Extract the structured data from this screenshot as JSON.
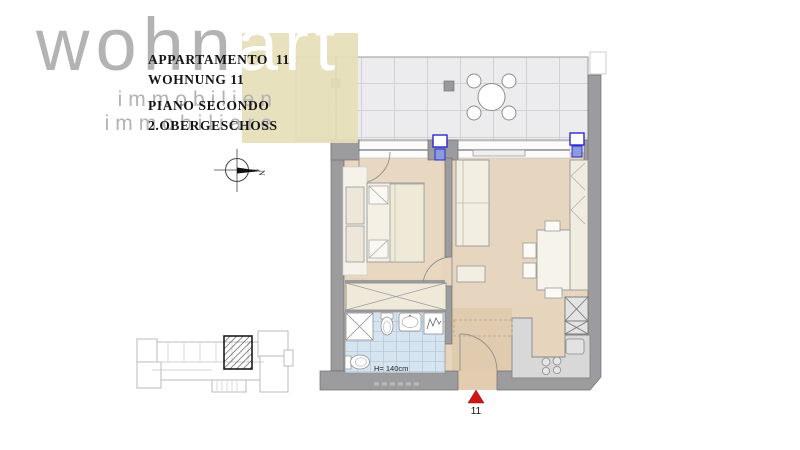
{
  "brand": {
    "name_gray": "wohn",
    "name_accent": "art",
    "subtitle_de": "immobilien",
    "subtitle_it": "immobiliare",
    "accent_block_color": "#e5dfb8",
    "letter_color": "#b3b3b3"
  },
  "unit_info": {
    "title_it": "APPARTAMENTO  11",
    "title_de": "WOHNUNG 11",
    "floor_it": "PIANO SECONDO",
    "floor_de": "2.OBERGESCHOSS"
  },
  "floor_plan": {
    "bathroom_height_label": "H= 140cm",
    "unit_marker": "11",
    "north_label": "N",
    "colors": {
      "wall": "#9c9c9e",
      "floor_wood": "#e6d4bc",
      "terrace_tile": "#ececee",
      "bathroom_tile": "#d6e4f0",
      "window_frame": "#2b2bd0",
      "furniture": "#f2eee1",
      "kitchen_counter": "#d8d8d8",
      "entrance_marker_red": "#d11414"
    }
  }
}
